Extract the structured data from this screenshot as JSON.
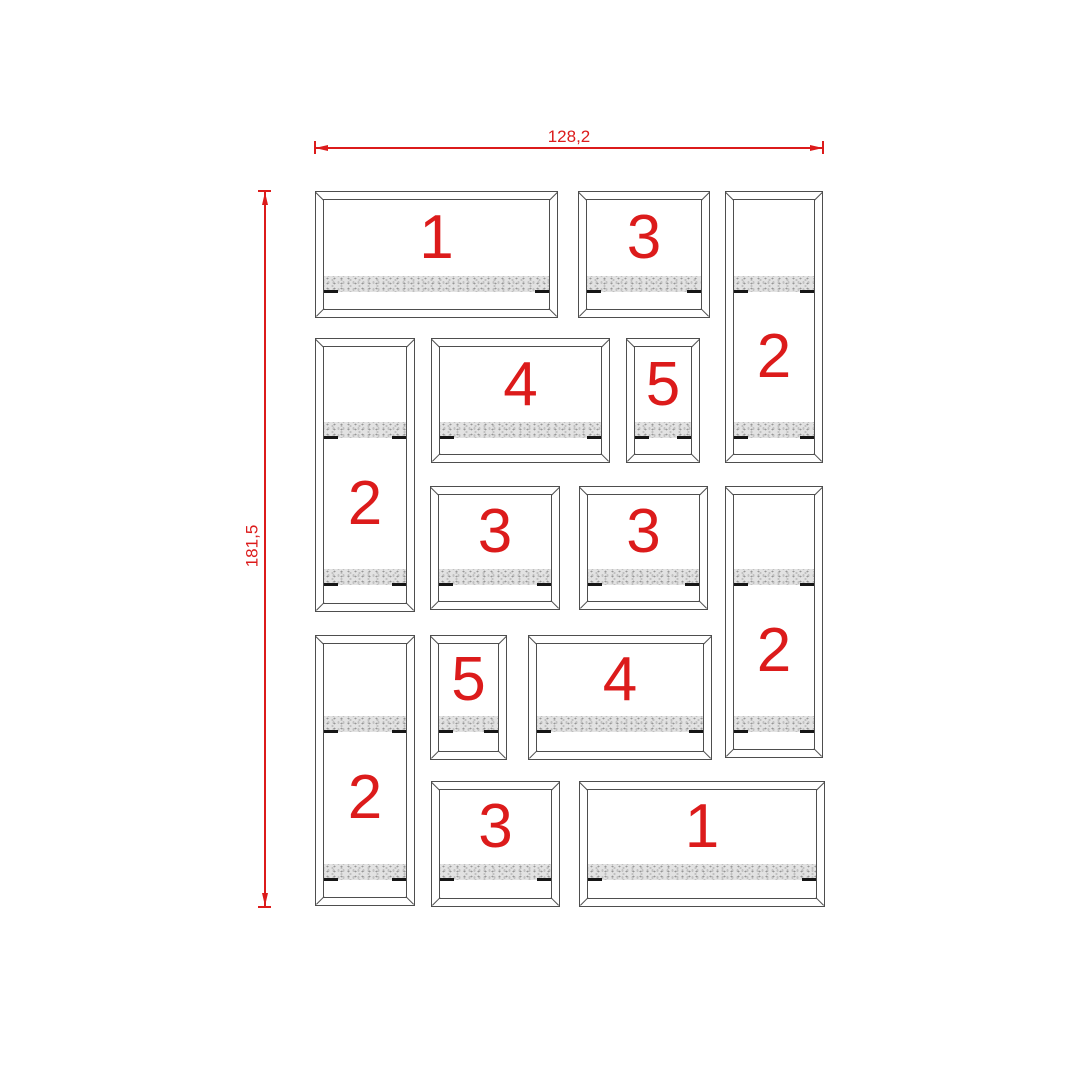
{
  "drawing": {
    "background": "#ffffff",
    "line_color": "#4e4e4e",
    "accent_color": "#dc1b1b",
    "tick_color": "#161616",
    "strip_base_color": "#e2e2e2",
    "frame_inset": 8,
    "strip_height": 16,
    "dimensions": {
      "horizontal": {
        "label": "128,2"
      },
      "vertical": {
        "label": "181,5"
      }
    },
    "frames": [
      {
        "label": "1",
        "x": 315,
        "y": 191,
        "w": 243,
        "h": 127,
        "strips": [
          84
        ]
      },
      {
        "label": "3",
        "x": 578,
        "y": 191,
        "w": 132,
        "h": 127,
        "strips": [
          84
        ]
      },
      {
        "label": "2",
        "x": 725,
        "y": 191,
        "w": 98,
        "h": 272,
        "strips": [
          84,
          230
        ]
      },
      {
        "label": "2",
        "x": 315,
        "y": 338,
        "w": 100,
        "h": 274,
        "strips": [
          83,
          230
        ]
      },
      {
        "label": "4",
        "x": 431,
        "y": 338,
        "w": 179,
        "h": 125,
        "strips": [
          83
        ]
      },
      {
        "label": "5",
        "x": 626,
        "y": 338,
        "w": 74,
        "h": 125,
        "strips": [
          83
        ]
      },
      {
        "label": "3",
        "x": 430,
        "y": 486,
        "w": 130,
        "h": 124,
        "strips": [
          82
        ]
      },
      {
        "label": "3",
        "x": 579,
        "y": 486,
        "w": 129,
        "h": 124,
        "strips": [
          82
        ]
      },
      {
        "label": "2",
        "x": 725,
        "y": 486,
        "w": 98,
        "h": 272,
        "strips": [
          82,
          229
        ]
      },
      {
        "label": "2",
        "x": 315,
        "y": 635,
        "w": 100,
        "h": 271,
        "strips": [
          80,
          228
        ]
      },
      {
        "label": "5",
        "x": 430,
        "y": 635,
        "w": 77,
        "h": 125,
        "strips": [
          80
        ]
      },
      {
        "label": "4",
        "x": 528,
        "y": 635,
        "w": 184,
        "h": 125,
        "strips": [
          80
        ]
      },
      {
        "label": "3",
        "x": 431,
        "y": 781,
        "w": 129,
        "h": 126,
        "strips": [
          82
        ]
      },
      {
        "label": "1",
        "x": 579,
        "y": 781,
        "w": 246,
        "h": 126,
        "strips": [
          82
        ]
      }
    ]
  }
}
